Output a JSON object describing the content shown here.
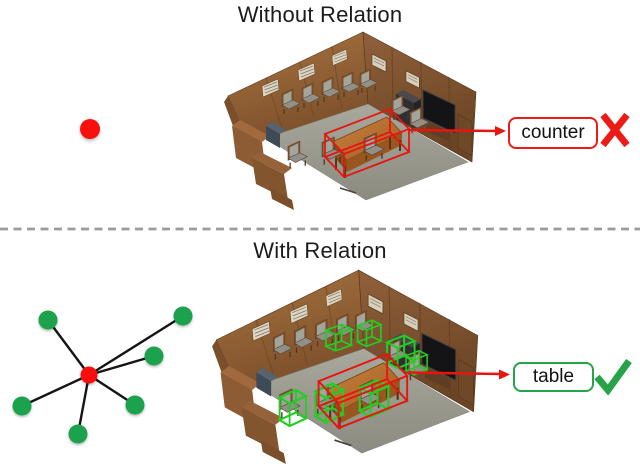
{
  "top_panel": {
    "title": "Without Relation",
    "prediction_label": "counter",
    "result_icon": "cross-icon"
  },
  "bottom_panel": {
    "title": "With Relation",
    "prediction_label": "table",
    "result_icon": "check-icon"
  },
  "graph": {
    "center": {
      "x": 89,
      "y": 375
    },
    "leaves": [
      {
        "x": 48,
        "y": 320
      },
      {
        "x": 183,
        "y": 316
      },
      {
        "x": 154,
        "y": 356
      },
      {
        "x": 135,
        "y": 405
      },
      {
        "x": 22,
        "y": 406
      },
      {
        "x": 78,
        "y": 434
      }
    ],
    "node_radius": 9.5,
    "center_radius": 8.5,
    "edge_width": 2.4
  },
  "colors": {
    "red_accent": "#ec1b16",
    "arrow_red": "#e8150e",
    "green_accent": "#27a348",
    "bbox_green": "#24cd24",
    "node_green": "#1fa24e",
    "node_red": "#f9100d",
    "edge_black": "#151515",
    "divider_gray": "#9b9b9b",
    "label_text": "#111111",
    "title_text": "#1b1b1b"
  }
}
